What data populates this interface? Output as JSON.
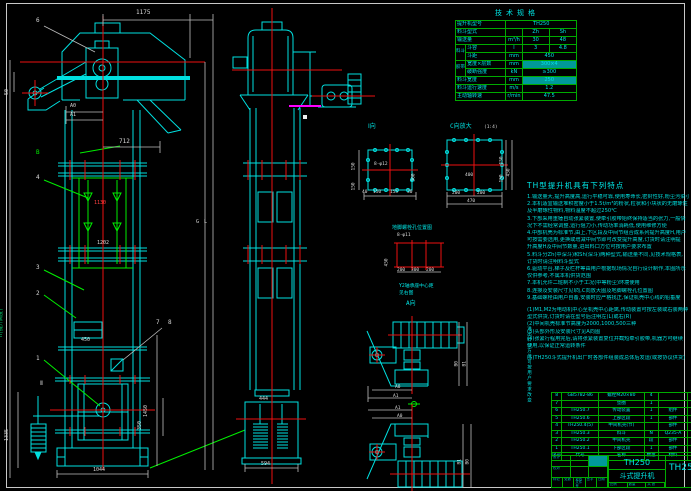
{
  "colors": {
    "line_cyan": "#00e0e0",
    "line_green": "#00ee00",
    "line_red": "#ee1111",
    "line_white": "#d9d9d9",
    "text_cyan": "#00e5e5",
    "highlight": "#009999",
    "background": "#000000",
    "magenta": "#ff00ff"
  },
  "spec": {
    "title": "技术规格",
    "model_label": "提升机型号",
    "model": "TH250",
    "bucket_type_label": "料斗型式",
    "type1": "Zh",
    "type2": "Sh",
    "capacity_label": "输送量",
    "capacity_unit": "m³/h",
    "cap1": "30",
    "cap2": "48",
    "bucket_group": "料斗",
    "vol_label": "斗容",
    "vol_unit": "l",
    "vol1": "3",
    "vol2": "4.8",
    "pitch_label": "斗距",
    "pitch_unit": "mm",
    "pitch": "450",
    "belt_group": "胶带",
    "belt_label": "宽度×层数",
    "belt_unit": "mm",
    "belt": "300×4",
    "strength_label": "破断强度",
    "strength_unit": "kN",
    "strength": "≥300",
    "width_label": "料斗宽度",
    "width_unit": "mm",
    "width": "250",
    "speed_label": "料斗运行速度",
    "speed_unit": "m/s",
    "speed": "1.2",
    "rpm_label": "主动轴转速",
    "rpm_unit": "r/min",
    "rpm": "47.5"
  },
  "notes": {
    "title": "TH型提升机具有下列特点",
    "lines": [
      "1.输送量大,提升高度高,运行平稳可靠,使用寿命长,密封性好,粉尘污染小",
      "2.本机适宜输送堆积密度小于1.5t/m³的粉状,粒状和小块状的无磨琢性",
      "  及半磨琢性物料,物料温度不超过250℃",
      "3.下部采用重锤自动张紧装置,使牵引胶带始终保持适当的张力,一般情",
      "  况下不需经常调整,运行阻力小,传动功率消耗低,使用维修方便",
      "4.中部机壳为标准节,由上,下区段及中间节组合成系列提升高度H,用户",
      "  可按需要选用,更换或增减中间节即可改变提升高度,订货时请注明提",
      "  升高度H及中间节数量,进出料口方位可按用户要求布置",
      "5.料斗分Zh(中深斗)和Sh(深斗)两种型式,输送量不同,见技术规格表,",
      "  订货时请注明料斗型式",
      "6.驱动平台,梯子及栏杆等由用户根据现场情况自行设计制作,本图所示",
      "  仅供参考,不属本机供货范围",
      "7.本机允许二班制不小于工况(中等粉尘)环境使用",
      "8.连接及安装尺寸见Ⅰ向,C向放大图及地脚螺栓孔位置图",
      "9.基础螺栓由用户自备,安装时应严格找正,保证机壳中心线的铅垂度",
      "",
      "(1)M1,M2为电动机中心至机壳中心距离,传动装置可按左装或右装两种",
      "   型式供货,订货时请在型号后注明左(L)或右(R)",
      "(2)中间机壳标准节高度为2000,1000,500三种",
      "(3)头部外形及安装尺寸见A向图",
      "(4)张紧行程用完后,请将张紧装置复位并截短牵引胶带,机器方可继续",
      "   使用,以保证正常运转条件",
      "",
      "(5)TH250斗式提升机出厂时各部件组装成总体后发运(或按协议供货)"
    ]
  },
  "bom": {
    "headers": [
      "序号",
      "代号",
      "名称",
      "数量",
      "材料",
      "重量"
    ],
    "rows": [
      {
        "no": "8",
        "code": "GB5782-86",
        "name": "螺栓M20×80",
        "qty": "4",
        "mat": "",
        "wt": "0.09"
      },
      {
        "no": "7",
        "code": "",
        "name": "垫圈",
        "qty": "1",
        "mat": "",
        "wt": "0.05"
      },
      {
        "no": "6",
        "code": "TH250.7",
        "name": "传动装置",
        "qty": "1",
        "mat": "组件",
        "wt": ""
      },
      {
        "no": "5",
        "code": "TH250.6",
        "name": "上部区段",
        "qty": "1",
        "mat": "部件",
        "wt": ""
      },
      {
        "no": "4",
        "code": "TH250.4(5)",
        "name": "中间机壳(节)",
        "qty": "",
        "mat": "部件",
        "wt": ""
      },
      {
        "no": "3",
        "code": "TH250.3",
        "name": "料斗",
        "qty": "N",
        "mat": "Q235-A",
        "wt": "204"
      },
      {
        "no": "2",
        "code": "TH250.2",
        "name": "中间机壳",
        "qty": "段",
        "mat": "部件",
        "wt": ""
      },
      {
        "no": "1",
        "code": "TH250.1",
        "name": "下部区段",
        "qty": "1",
        "mat": "部件",
        "wt": ""
      }
    ]
  },
  "title_block": {
    "model": "TH250",
    "name": "斗式提升机",
    "drawing_no": "TH250",
    "sign1": "设计",
    "sign2": "校对",
    "rev1": "标记",
    "rev2": "处数",
    "rev3": "更改文件号",
    "rev4": "签字",
    "rev5": "日期",
    "scale_label": "比例",
    "qty_label": "数量",
    "sheet_label": "共 张"
  },
  "labels": [
    {
      "t": "6",
      "x": 36,
      "y": 18,
      "n": "balloon-6"
    },
    {
      "t": "1175",
      "x": 136,
      "y": 10,
      "s": 6
    },
    {
      "t": "712",
      "x": 119,
      "y": 139,
      "s": 6
    },
    {
      "t": "A0",
      "x": 70,
      "y": 104,
      "s": 5
    },
    {
      "t": "A1",
      "x": 70,
      "y": 113,
      "s": 5
    },
    {
      "t": "50",
      "x": 10,
      "y": 90,
      "s": 5,
      "r": 1
    },
    {
      "t": "B",
      "x": 36,
      "y": 150,
      "c": "#00ee00",
      "n": "balloon-B"
    },
    {
      "t": "4",
      "x": 36,
      "y": 175,
      "n": "balloon-4"
    },
    {
      "t": "1130",
      "x": 94,
      "y": 201,
      "c": "#ff4040",
      "s": 5
    },
    {
      "t": "1202",
      "x": 97,
      "y": 241,
      "s": 5
    },
    {
      "t": "3",
      "x": 36,
      "y": 265,
      "n": "balloon-3"
    },
    {
      "t": "2",
      "x": 36,
      "y": 291,
      "n": "balloon-2"
    },
    {
      "t": "1",
      "x": 36,
      "y": 356,
      "n": "balloon-1"
    },
    {
      "t": "7",
      "x": 156,
      "y": 320,
      "n": "balloon-7"
    },
    {
      "t": "8",
      "x": 168,
      "y": 320,
      "n": "balloon-8"
    },
    {
      "t": "Ⅱ",
      "x": 40,
      "y": 381,
      "s": 6
    },
    {
      "t": "450",
      "x": 81,
      "y": 338,
      "s": 5
    },
    {
      "t": "1335",
      "x": 10,
      "y": 436,
      "s": 5,
      "r": 1
    },
    {
      "t": "1450",
      "x": 149,
      "y": 412,
      "s": 5,
      "r": 1
    },
    {
      "t": "350",
      "x": 143,
      "y": 425,
      "s": 5,
      "r": 1
    },
    {
      "t": "G",
      "x": 196,
      "y": 220,
      "s": 5
    },
    {
      "t": "L",
      "x": 204,
      "y": 220,
      "s": 5
    },
    {
      "t": "1044",
      "x": 93,
      "y": 468,
      "s": 5
    },
    {
      "t": "H(提升高度)",
      "x": 4,
      "y": 332,
      "s": 5,
      "r": 1,
      "c": "#00d070"
    },
    {
      "t": "444",
      "x": 259,
      "y": 397,
      "s": 5
    },
    {
      "t": "594",
      "x": 261,
      "y": 462,
      "s": 5
    },
    {
      "t": "Ⅰ向",
      "x": 368,
      "y": 124,
      "s": 6,
      "c": "#00e5e5",
      "n": "view-label-I"
    },
    {
      "t": "8-φ12",
      "x": 374,
      "y": 163,
      "s": 4.5
    },
    {
      "t": "150",
      "x": 357,
      "y": 166,
      "s": 4.5,
      "r": 1
    },
    {
      "t": "150",
      "x": 357,
      "y": 186,
      "s": 4.5,
      "r": 1
    },
    {
      "t": "300",
      "x": 417,
      "y": 177,
      "s": 4.5,
      "r": 1
    },
    {
      "t": "40",
      "x": 362,
      "y": 191,
      "s": 4.5
    },
    {
      "t": "150",
      "x": 373,
      "y": 191,
      "s": 4.5
    },
    {
      "t": "155",
      "x": 390,
      "y": 191,
      "s": 4.5
    },
    {
      "t": "30",
      "x": 407,
      "y": 191,
      "s": 4.5
    },
    {
      "t": "C向放大",
      "x": 450,
      "y": 124,
      "s": 6,
      "c": "#00e5e5",
      "n": "view-label-C"
    },
    {
      "t": "(1:4)",
      "x": 484,
      "y": 126,
      "s": 4.5
    },
    {
      "t": "400",
      "x": 465,
      "y": 174,
      "s": 4.5
    },
    {
      "t": "200",
      "x": 452,
      "y": 192,
      "s": 4.5
    },
    {
      "t": "200",
      "x": 477,
      "y": 192,
      "s": 4.5
    },
    {
      "t": "470",
      "x": 467,
      "y": 200,
      "s": 4.5
    },
    {
      "t": "150",
      "x": 505,
      "y": 160,
      "s": 4.5,
      "r": 1
    },
    {
      "t": "150",
      "x": 505,
      "y": 178,
      "s": 4.5,
      "r": 1
    },
    {
      "t": "450",
      "x": 512,
      "y": 172,
      "s": 4.5,
      "r": 1
    },
    {
      "t": "地脚螺栓孔位置图",
      "x": 392,
      "y": 226,
      "s": 5,
      "c": "#00e5e5",
      "n": "view-label-anchor-plan"
    },
    {
      "t": "8-φ11",
      "x": 397,
      "y": 234,
      "s": 4.5
    },
    {
      "t": "450",
      "x": 390,
      "y": 262,
      "s": 4.5,
      "r": 1
    },
    {
      "t": "200",
      "x": 397,
      "y": 269,
      "s": 4.5
    },
    {
      "t": "300",
      "x": 411,
      "y": 269,
      "s": 4.5
    },
    {
      "t": "200",
      "x": 426,
      "y": 269,
      "s": 4.5
    },
    {
      "t": "Y2轴承座中心距",
      "x": 399,
      "y": 285,
      "s": 4.8,
      "c": "#00e5e5"
    },
    {
      "t": "见右图",
      "x": 399,
      "y": 292,
      "s": 4.8,
      "c": "#00e5e5"
    },
    {
      "t": "A向",
      "x": 406,
      "y": 301,
      "s": 6,
      "c": "#00e5e5",
      "n": "view-label-A"
    },
    {
      "t": "A0",
      "x": 395,
      "y": 386,
      "s": 4.5
    },
    {
      "t": "A1",
      "x": 393,
      "y": 395,
      "s": 4.5
    },
    {
      "t": "B0",
      "x": 460,
      "y": 362,
      "s": 4.5,
      "r": 1
    },
    {
      "t": "B1",
      "x": 468,
      "y": 362,
      "s": 4.5,
      "r": 1
    },
    {
      "t": "A1",
      "x": 395,
      "y": 407,
      "s": 4.5
    },
    {
      "t": "A0",
      "x": 397,
      "y": 415,
      "s": 4.5
    },
    {
      "t": "B1",
      "x": 463,
      "y": 460,
      "s": 4.5,
      "r": 1
    },
    {
      "t": "B0",
      "x": 471,
      "y": 460,
      "s": 4.5,
      "r": 1
    },
    {
      "t": "进出料口方位可按用户要求改变",
      "x": 526,
      "y": 326,
      "s": 4.5,
      "c": "#00e5e5",
      "v": 1
    }
  ]
}
